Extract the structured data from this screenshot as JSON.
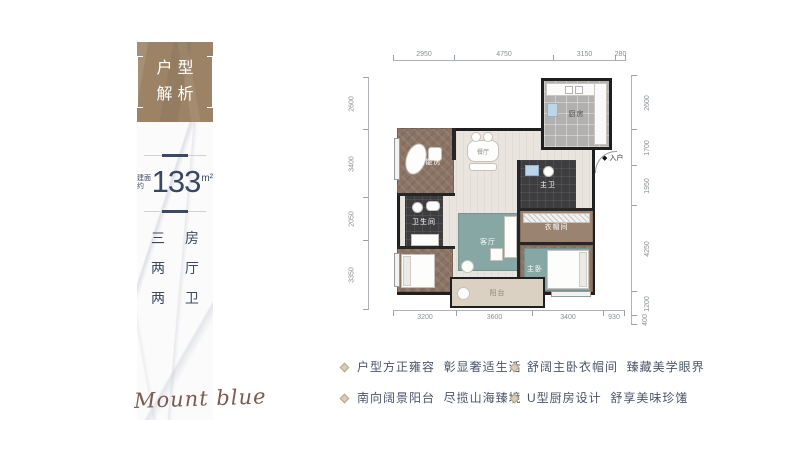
{
  "colors": {
    "brand_brown": "#9c8365",
    "navy_text": "#3c4962",
    "wall": "#1f1f1f",
    "teal_rug": "#86a7a3",
    "signature_brown": "#6d4a3e",
    "bullet_tan": "#b5a78a"
  },
  "left_panel": {
    "title_line1": "户型",
    "title_line2": "解析",
    "area_prefix": "建面约",
    "area_value": "133",
    "area_unit": "m²",
    "layout_lines": [
      "三 房",
      "两 厅",
      "两 卫"
    ],
    "signature": "Mount blue"
  },
  "plan": {
    "entry_label": "入户",
    "entry_arrow": "◆",
    "rooms": [
      {
        "label": "多功能房"
      },
      {
        "label": "餐厅"
      },
      {
        "label": "厨房"
      },
      {
        "label": "卫生间"
      },
      {
        "label": "主卫"
      },
      {
        "label": "衣帽间"
      },
      {
        "label": "客厅"
      },
      {
        "label": "卧室"
      },
      {
        "label": "主卧"
      },
      {
        "label": "阳台"
      }
    ],
    "dims": {
      "top": [
        "2950",
        "4750",
        "3150",
        "280"
      ],
      "bottom": [
        "3200",
        "3600",
        "3400",
        "930"
      ],
      "left": [
        "2600",
        "3400",
        "2050",
        "3350"
      ],
      "right": [
        "2600",
        "1700",
        "1950",
        "4250",
        "1200",
        "400"
      ]
    }
  },
  "features": [
    {
      "text": "户型方正雍容  彰显奢适生活"
    },
    {
      "text": "南向阔景阳台  尽揽山海臻境"
    },
    {
      "text": "舒阔主卧衣帽间  臻藏美学眼界"
    },
    {
      "text": "U型厨房设计  舒享美味珍馐"
    }
  ]
}
